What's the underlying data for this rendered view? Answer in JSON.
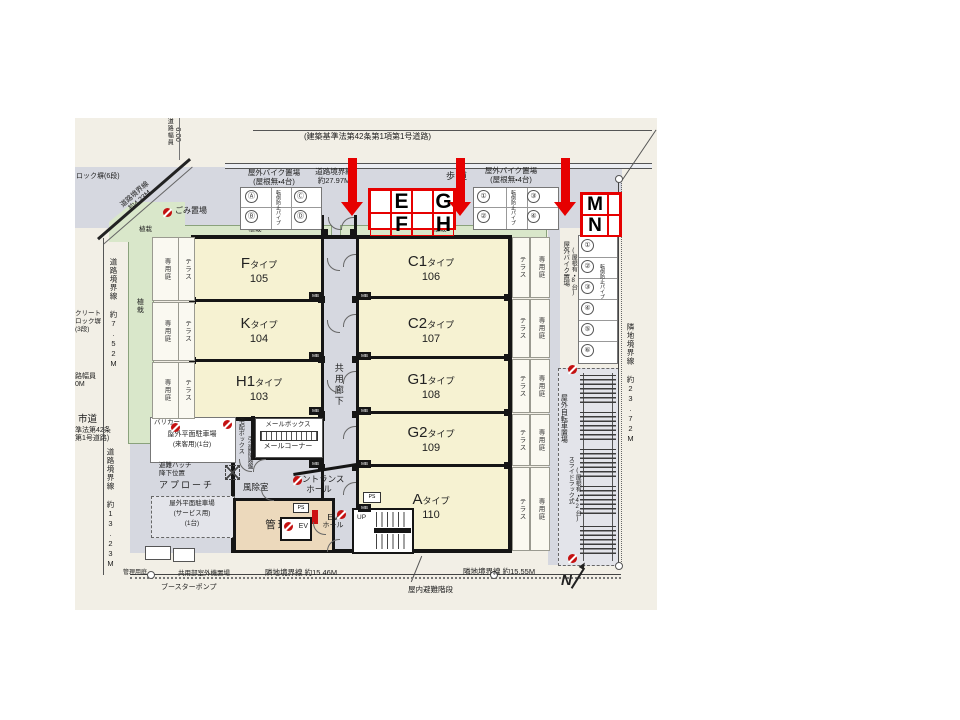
{
  "colors": {
    "red": "#e60000",
    "room_fill": "#f6f2d2",
    "corridor_fill": "#d6d8e0",
    "planting_green": "#d9e7ca",
    "manager_tan": "#ecd9bc"
  },
  "top": {
    "law_road": "(建築基準法第42条第1項第1号道路)",
    "road_width_label": "道路幅員",
    "road_width_value": "6.00",
    "bike_parking_noroof_1": "屋外バイク置場",
    "bike_parking_noroof_2": "(屋根無・4台)",
    "road_boundary_2797_1": "道路境界線",
    "road_boundary_2797_2": "約27.97M",
    "sidewalk": "歩道"
  },
  "left_edge": {
    "block_wall_6": "ロック塀(6段)",
    "road_boundary_423_1": "道路境界線",
    "road_boundary_423_2": "約4.23M",
    "garbage": "ごみ置場",
    "planting": "植栽",
    "road_boundary_752": "道路境界線 約7.52M",
    "concrete_wall_1": "クリート",
    "concrete_wall_2": "ロック塀",
    "concrete_wall_3": "(3段)",
    "road_width_frag_1": "路幅員",
    "road_width_frag_2": "0M",
    "city_road": "市道",
    "city_road_law_1": "準法第42条",
    "city_road_law_2": "第1号道路)",
    "road_boundary_1323": "道路境界線 約13.23M"
  },
  "strips": {
    "terrace": "テラス",
    "private_garden": "専用庭",
    "planting": "植栽",
    "corridor": "共用廊下"
  },
  "rooms": {
    "left": [
      {
        "letter": "F",
        "suffix": "タイプ",
        "num": "105"
      },
      {
        "letter": "K",
        "suffix": "タイプ",
        "num": "104"
      },
      {
        "letter": "H1",
        "suffix": "タイプ",
        "num": "103"
      }
    ],
    "right": [
      {
        "letter": "C1",
        "suffix": "タイプ",
        "num": "106"
      },
      {
        "letter": "C2",
        "suffix": "タイプ",
        "num": "107"
      },
      {
        "letter": "G1",
        "suffix": "タイプ",
        "num": "108"
      },
      {
        "letter": "G2",
        "suffix": "タイプ",
        "num": "109"
      },
      {
        "letter": "A",
        "suffix": "タイプ",
        "num": "110"
      }
    ]
  },
  "stalls": {
    "left": [
      "Ⓐ",
      "Ⓒ",
      "Ⓑ",
      "Ⓓ"
    ],
    "right": [
      "①",
      "③",
      "②",
      "④"
    ],
    "side": [
      "①",
      "②",
      "③",
      "④",
      "⑤",
      "⑥"
    ],
    "tip_note": "転倒防止パイプ"
  },
  "annotations": {
    "e": "E",
    "f": "F",
    "g": "G",
    "h": "H",
    "m": "M",
    "n": "N"
  },
  "lower_left": {
    "barricade": "バリカー",
    "visitor_parking_1": "屋外平面駐車場",
    "visitor_parking_2": "(来客用)(1台)",
    "hatch_1": "避難ハッチ",
    "hatch_2": "降下位置",
    "approach": "アプローチ",
    "windbreak": "風除室",
    "entrance_1": "エントランス",
    "entrance_2": "ホール",
    "mailbox": "メールボックス",
    "mail_corner": "メールコーナー",
    "delivery_box": "宅配ボックス",
    "switchboard": "引込開閉器盤",
    "service_parking_1": "屋外平面駐車場",
    "service_parking_2": "(サービス用)",
    "service_parking_3": "(1台)",
    "manager_room": "管理室",
    "ev": "EV",
    "ev_hall_1": "EV",
    "ev_hall_2": "ホール",
    "ps": "PS",
    "up": "UP",
    "mb": "MB"
  },
  "bottom": {
    "mgmt_garden": "管理用庭",
    "booster_pump": "ブースターポンプ",
    "outdoor_units": "共用部室外機置場",
    "adj_boundary_1546": "隣地境界線 約15.46M",
    "adj_boundary_1555": "隣地境界線 約15.55M",
    "indoor_stairs": "屋内避難階段",
    "north": "N"
  },
  "right_side": {
    "bike_roofed_1": "屋外バイク置場",
    "bike_roofed_2": "(屋根有・8台)",
    "bicycle_1": "屋外自転車置場",
    "bicycle_2": "スライドラック式",
    "bicycle_3": "(屋根有・42台)",
    "adj_boundary_2372": "隣地境界線 約23.72M"
  }
}
